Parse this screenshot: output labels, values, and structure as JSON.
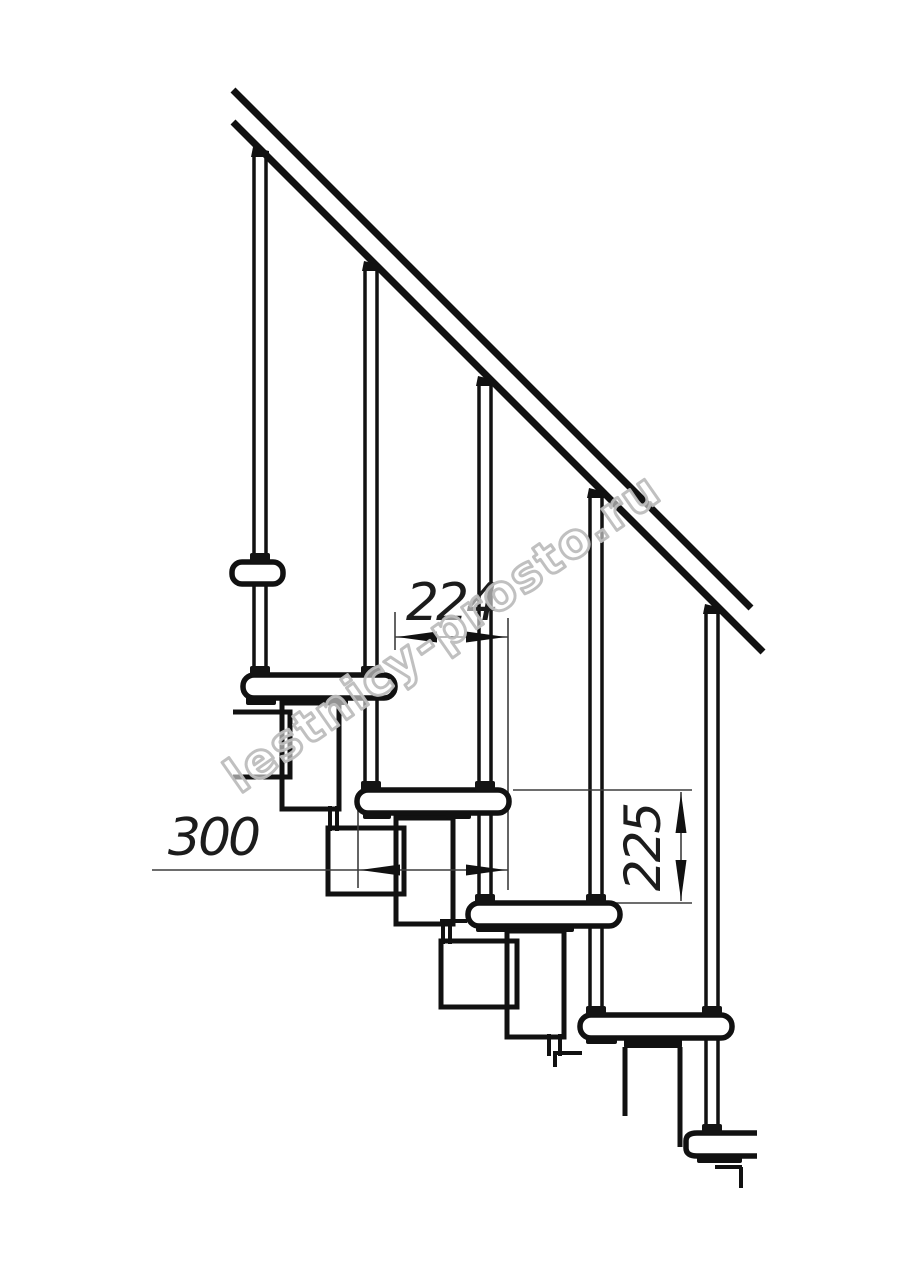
{
  "drawing": {
    "type": "technical line drawing",
    "subject": "modular staircase side elevation with handrail, balusters, treads and support modules",
    "background_color": "#ffffff",
    "line_color": "#111111",
    "thin_line_color": "#3d3d3d",
    "dimensions": {
      "step_run": "224",
      "tread_depth": "300",
      "step_rise": "225"
    },
    "watermark": {
      "text": "lestnicy-prosto.ru",
      "color": "#bdbdbd",
      "rotation_deg": -35
    }
  }
}
